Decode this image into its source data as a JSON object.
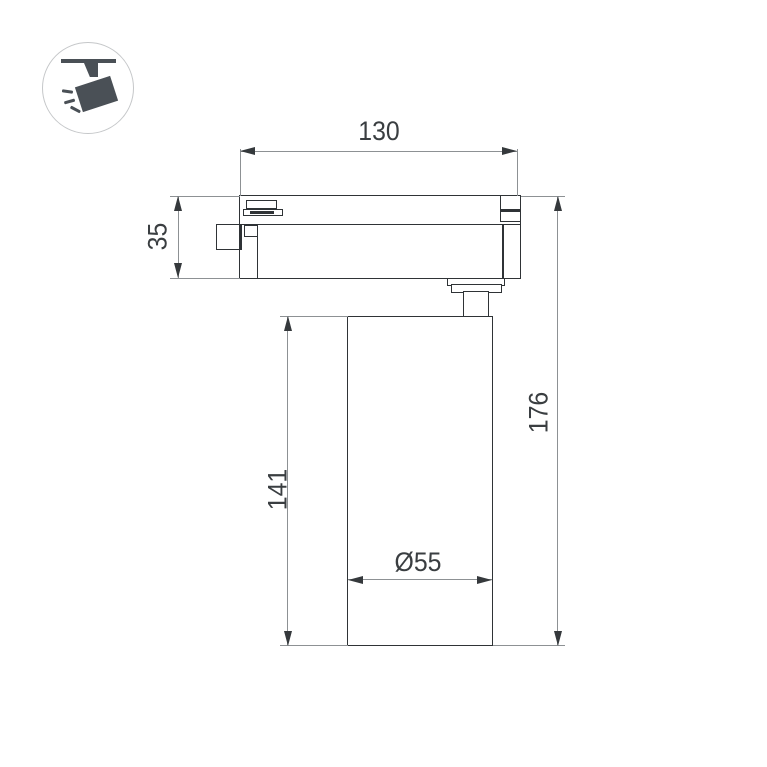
{
  "icon": {
    "name": "ceiling-track-spotlight-pictogram"
  },
  "labels": {
    "width": "130",
    "adapter_height": "35",
    "body_height": "141",
    "total_height": "176",
    "diameter": "Ø55"
  },
  "colors": {
    "background": "#ffffff",
    "outline": "#2f3336",
    "dimension_line": "#8d9194",
    "arrow": "#35393c",
    "text": "#3a3e41",
    "icon_fill": "#4a5056",
    "icon_circle_border": "#c5c7c9"
  }
}
